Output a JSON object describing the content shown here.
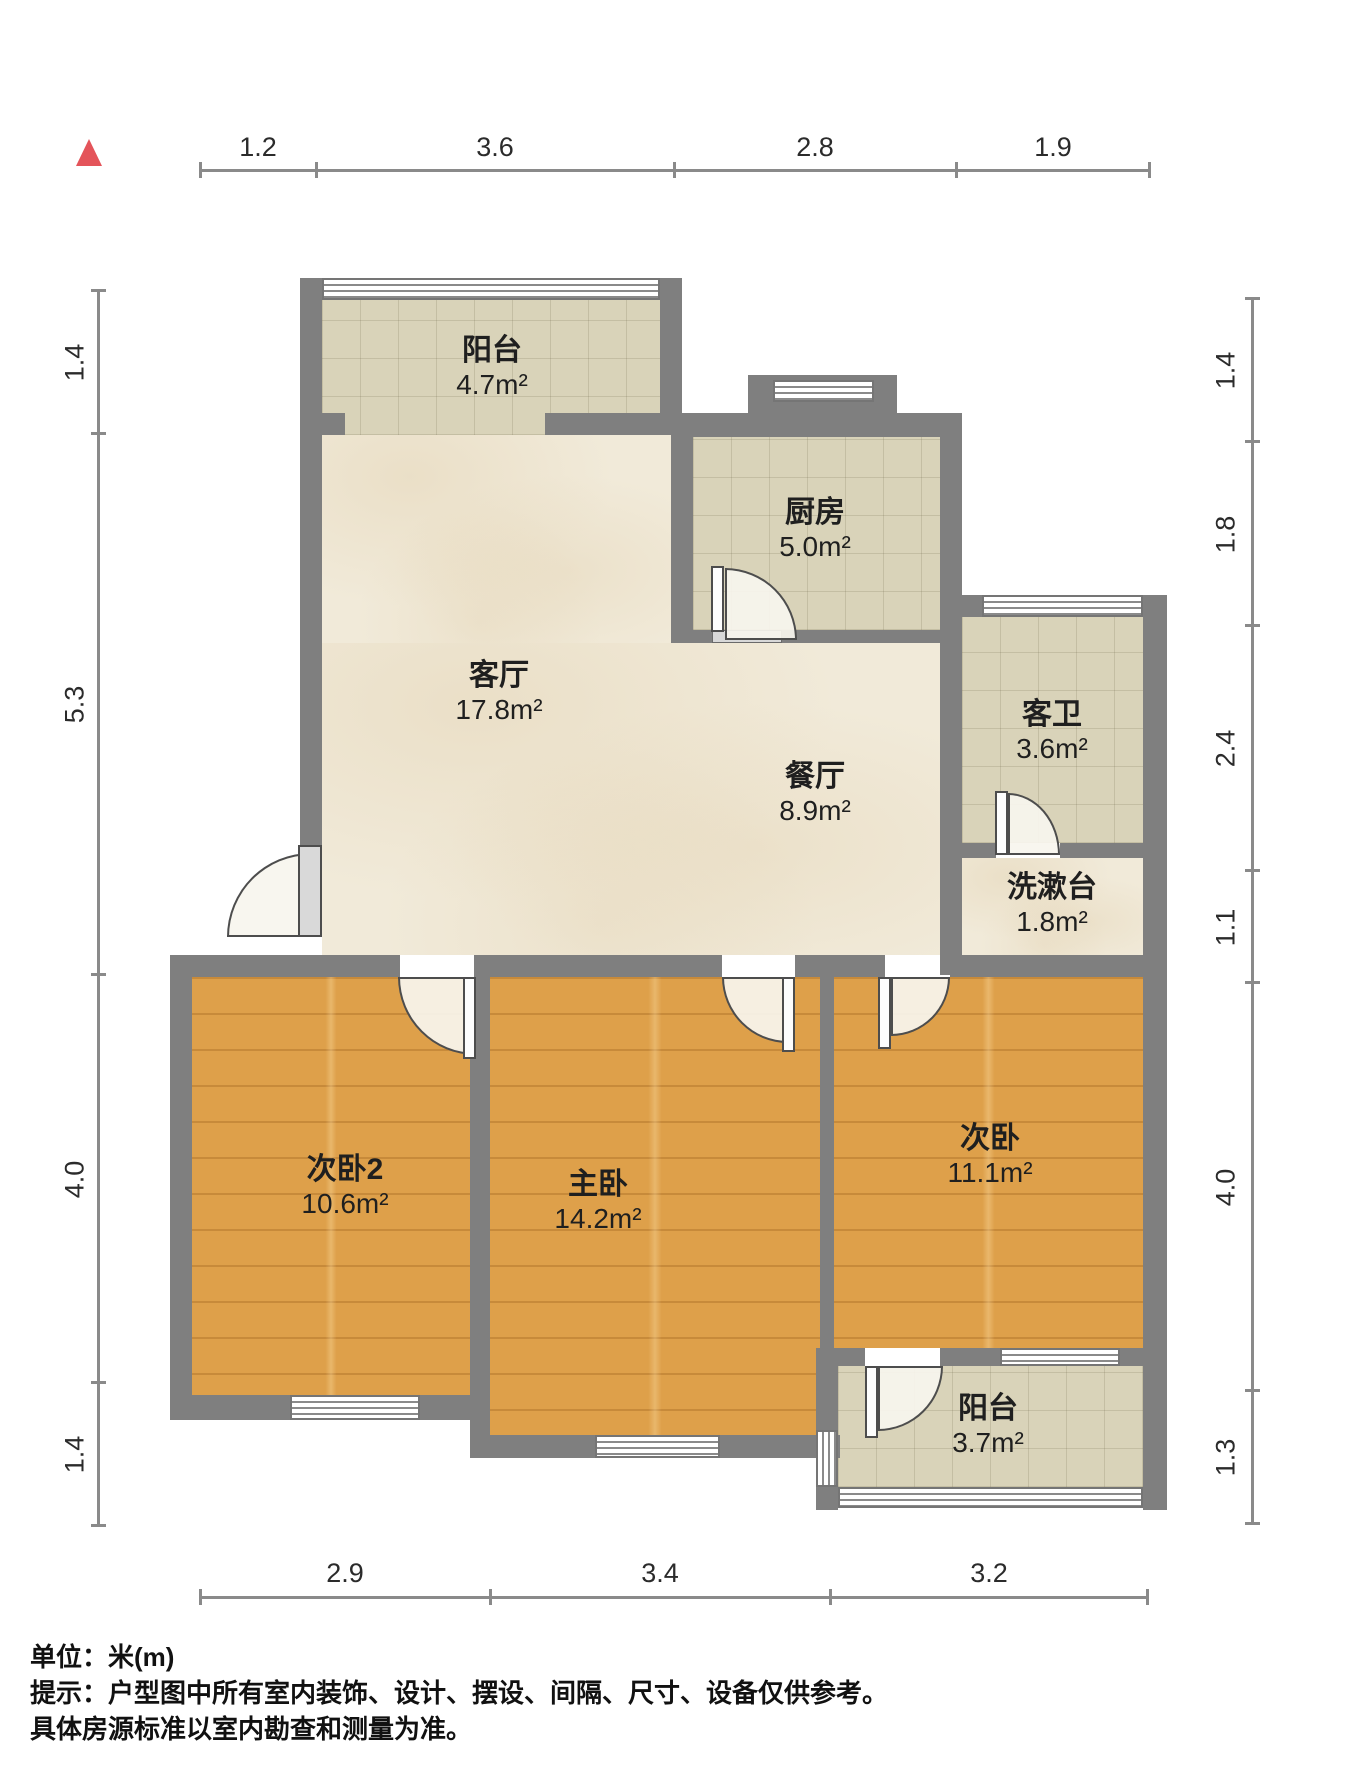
{
  "rooms": {
    "balcony_top": {
      "name": "阳台",
      "area": "4.7m²"
    },
    "kitchen": {
      "name": "厨房",
      "area": "5.0m²"
    },
    "living": {
      "name": "客厅",
      "area": "17.8m²"
    },
    "dining": {
      "name": "餐厅",
      "area": "8.9m²"
    },
    "bathroom": {
      "name": "客卫",
      "area": "3.6m²"
    },
    "washstand": {
      "name": "洗漱台",
      "area": "1.8m²"
    },
    "bedroom2": {
      "name": "次卧2",
      "area": "10.6m²"
    },
    "master": {
      "name": "主卧",
      "area": "14.2m²"
    },
    "bedroom": {
      "name": "次卧",
      "area": "11.1m²"
    },
    "balcony_bottom": {
      "name": "阳台",
      "area": "3.7m²"
    }
  },
  "dimensions": {
    "top": [
      "1.2",
      "3.6",
      "2.8",
      "1.9"
    ],
    "bottom": [
      "2.9",
      "3.4",
      "3.2"
    ],
    "left": [
      "1.4",
      "5.3",
      "4.0",
      "1.4"
    ],
    "right": [
      "1.4",
      "1.8",
      "2.4",
      "1.1",
      "4.0",
      "1.3"
    ]
  },
  "footer": {
    "unit": "单位：米(m)",
    "hint_line1": "提示：户型图中所有室内装饰、设计、摆设、间隔、尺寸、设备仅供参考。",
    "hint_line2": "具体房源标准以室内勘查和测量为准。"
  },
  "colors": {
    "wall": "#7f7f7f",
    "tile_floor": "#d9d3b9",
    "marble_floor": "#f1ead9",
    "wood_floor": "#dea04a",
    "north_arrow": "#e4545a",
    "dimension_line": "#8a8a8a"
  }
}
